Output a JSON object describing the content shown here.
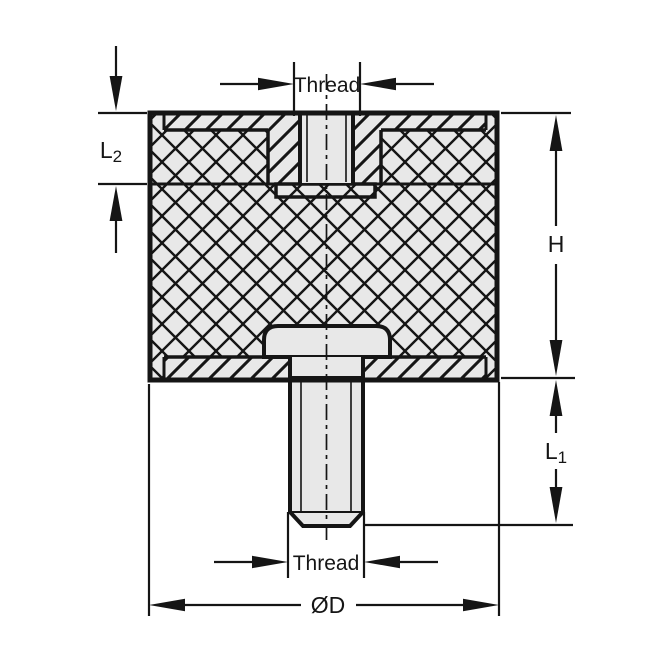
{
  "drawing": {
    "kind": "technical-section-view",
    "part": "cylindrical rubber mount with female thread top and male stud bottom"
  },
  "labels": {
    "thread_top": "Thread",
    "thread_bottom": "Thread",
    "height": "H",
    "length_lower_main": "L",
    "length_lower_sub": "1",
    "length_upper_main": "L",
    "length_upper_sub": "2",
    "diameter": "ØD"
  },
  "colors": {
    "line": "#151515",
    "fill": "#e8e8e8",
    "background": "#ffffff"
  }
}
